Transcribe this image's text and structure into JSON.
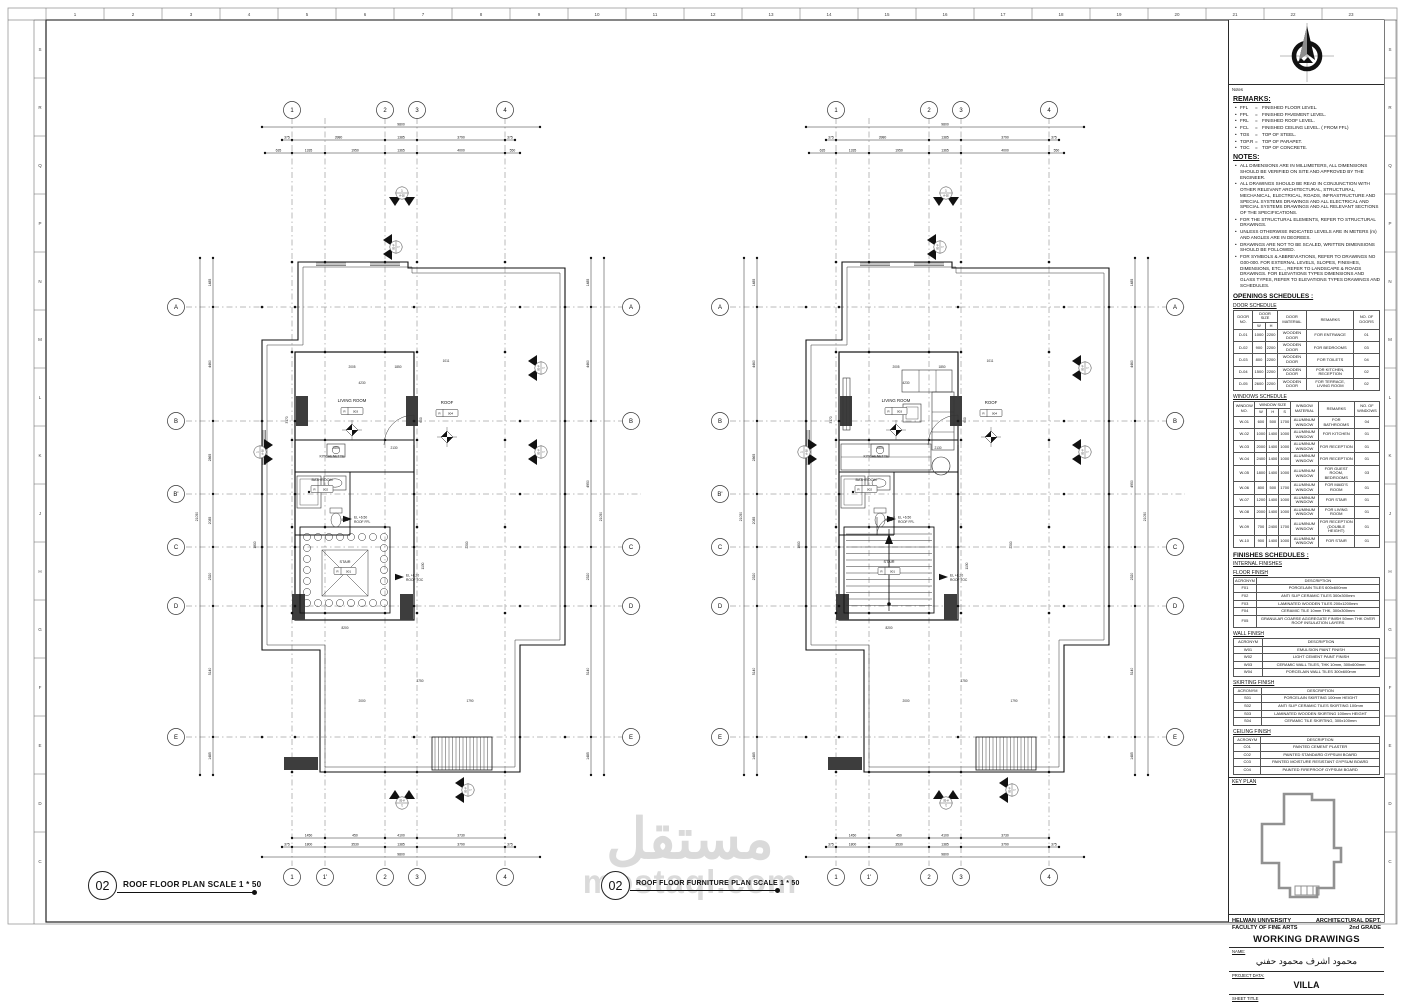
{
  "sheet": {
    "watermark_ar": "مستقل",
    "watermark_en": "mostaql.com",
    "ruler_top": [
      "1",
      "2",
      "3",
      "4",
      "5",
      "6",
      "7",
      "8",
      "9",
      "10",
      "11",
      "12",
      "13",
      "14",
      "15",
      "16",
      "17",
      "18",
      "19",
      "20",
      "21",
      "22",
      "23"
    ],
    "ruler_side": [
      "S",
      "R",
      "Q",
      "P",
      "N",
      "M",
      "L",
      "K",
      "J",
      "H",
      "G",
      "F",
      "E",
      "D",
      "C"
    ],
    "line_color": "#1a1a1a",
    "watermark_color": "#dadada"
  },
  "plan_titles": [
    {
      "number": "02",
      "label": "ROOF FLOOR PLAN SCALE 1 * 50"
    },
    {
      "number": "02",
      "label": "ROOF FLOOR FURNITURE PLAN SCALE 1 * 50"
    }
  ],
  "plans": {
    "grid_cols_top": [
      "1",
      "2",
      "3",
      "4"
    ],
    "grid_cols_bottom": [
      "1",
      "1'",
      "2",
      "3",
      "4"
    ],
    "grid_rows_left": [
      "A",
      "B",
      "B'",
      "C",
      "D",
      "E"
    ],
    "grid_rows_right": [
      "A",
      "B",
      "C",
      "D",
      "E"
    ],
    "section_tag": {
      "no": "1",
      "ref": "A-02"
    },
    "dims": {
      "top_total": "9800",
      "top_row2": [
        "375",
        "3980",
        "1385",
        "3790",
        "375"
      ],
      "top_row3": [
        "635",
        "1335",
        "1950",
        "1365",
        "4000",
        "550"
      ],
      "bottom_row1": [
        "1450",
        "450",
        "4100",
        "3730"
      ],
      "bottom_row2": [
        "375",
        "1800",
        "3530",
        "1385",
        "3790",
        "375"
      ],
      "bottom_total": "9800",
      "side_total": "21050",
      "side_segs": [
        "1485",
        "4460",
        "2865",
        "2085",
        "2320",
        "5140",
        "1485"
      ],
      "side_segs_right": [
        "1485",
        "4460",
        "4950",
        "2320",
        "5140",
        "1485"
      ],
      "inner": [
        "2005",
        "1850",
        "1011",
        "4230",
        "3170",
        "600",
        "2600",
        "2130",
        "5800",
        "1800",
        "2200",
        "1130",
        "8200",
        "3750",
        "1790",
        "2000"
      ]
    },
    "rooms": {
      "living": {
        "name": "LIVING ROOM",
        "tag_l": "R",
        "tag_n": "003"
      },
      "kitchenette": {
        "name": "KITCHENETTE"
      },
      "bathroom": {
        "name": "BATHROOM",
        "tag_l": "R",
        "tag_n": "002"
      },
      "stair": {
        "name": "STAIR",
        "tag_l": "R",
        "tag_n": "001"
      },
      "roof": {
        "name": "ROOF",
        "tag_l": "R",
        "tag_n": "004"
      }
    },
    "levels": [
      {
        "line1": "EL +6.50",
        "line2": "ROOF FFL"
      },
      {
        "line1": "EL +6.20",
        "line2": "ROOF TOC"
      }
    ]
  },
  "titleblock": {
    "issues_label": "Notes",
    "remarks_title": "REMARKS:",
    "remarks": [
      [
        "FFL",
        "FINISHED FLOOR LEVEL."
      ],
      [
        "FPL",
        "FINISHED PAVEMENT LEVEL."
      ],
      [
        "FRL",
        "FINISHED ROOF LEVEL."
      ],
      [
        "FCL",
        "FINISHED CEILING LEVEL. ( FROM FFL)"
      ],
      [
        "TOS",
        "TOP OF STEEL."
      ],
      [
        "TOP.R",
        "TOP OF PARAPET."
      ],
      [
        "TOC",
        "TOP OF CONCRETE."
      ]
    ],
    "notes_title": "NOTES:",
    "notes": [
      "ALL DIMENSIONS ARE IN MILLIMETERS, ALL DIMENSIONS SHOULD BE VERIFIED ON SITE AND APPROVED BY THE ENGINEER.",
      "ALL DRAWINGS SHOULD BE READ IN CONJUNCTION WITH OTHER RELEVANT ARCHITECTURAL, STRUCTURAL, MECHANICAL, ELECTRICAL, ROADS, INFRASTRUCTURE AND SPECIAL SYSTEMS DRAWINGS AND ALL ELECTRICAL AND SPECIAL SYSTEMS DRAWINGS AND ALL RELEVANT SECTIONS OF THE SPECIFICATIONS.",
      "FOR THE STRUCTURAL ELEMENTS, REFER TO STRUCTURAL DRAWINGS.",
      "UNLESS OTHERWISE INDICATED LEVELS ARE IN METERS (m) AND ANGLES ARE IN DEGREES.",
      "DRAWINGS ARE NOT TO BE SCALED, WRITTEN DIMENSIONS SHOULD BE FOLLOWED.",
      "FOR SYMBOLS & ABBREVIATIONS, REFER TO DRAWINGS NO G00-000. FOR EXTERNAL LEVELS, SLOPES, FINISHES, DIMENSIONS, ETC..., REFER TO LANDSCAPE & ROADS DRAWINGS. FOR ELEVATIONS TYPES DIMENSIONS AND GLASS TYPES, REFER TO ELEVATIONS TYPES DRAWINGS AND SCHEDULES."
    ],
    "openings_title": "OPENINGS SCHEDULES :",
    "door_schedule": {
      "title": "DOOR SCHEDULE",
      "head": [
        [
          {
            "t": "DOOR NO.",
            "rs": 2
          },
          {
            "t": "DOOR SIZE",
            "cs": 2
          },
          {
            "t": "DOOR MATERIAL",
            "rs": 2
          },
          {
            "t": "REMARKS",
            "rs": 2
          },
          {
            "t": "NO. OF DOORS",
            "rs": 2
          }
        ],
        [
          {
            "t": "W"
          },
          {
            "t": "H"
          }
        ]
      ],
      "rows": [
        [
          "D-01",
          "1000",
          "2200",
          "WOODEN DOOR",
          "FOR ENTRANCE",
          "01"
        ],
        [
          "D-02",
          "900",
          "2200",
          "WOODEN DOOR",
          "FOR BEDROOMS",
          "03"
        ],
        [
          "D-03",
          "800",
          "2200",
          "WOODEN DOOR",
          "FOR TOILETS",
          "04"
        ],
        [
          "D-04",
          "1500",
          "2200",
          "WOODEN DOOR",
          "FOR KITCHEN, RECEPTION",
          "02"
        ],
        [
          "D-05",
          "2600",
          "2200",
          "WOODEN DOOR",
          "FOR TERRACE, LIVING ROOM",
          "02"
        ]
      ]
    },
    "window_schedule": {
      "title": "WINDOWS SCHEDULE",
      "head": [
        [
          {
            "t": "WINDOW NO.",
            "rs": 2
          },
          {
            "t": "WINDOW SIZE",
            "cs": 3
          },
          {
            "t": "WINDOW MATERIAL",
            "rs": 2
          },
          {
            "t": "REMARKS",
            "rs": 2
          },
          {
            "t": "NO. OF WINDOWS",
            "rs": 2
          }
        ],
        [
          {
            "t": "W"
          },
          {
            "t": "H"
          },
          {
            "t": "S"
          }
        ]
      ],
      "rows": [
        [
          "W-01",
          "600",
          "500",
          "1700",
          "ALUMINUM WINDOW",
          "FOR BATHROOMS",
          "04"
        ],
        [
          "W-02",
          "1000",
          "1400",
          "1000",
          "ALUMINUM WINDOW",
          "FOR KITCHEN",
          "01"
        ],
        [
          "W-03",
          "2000",
          "1400",
          "1000",
          "ALUMINUM WINDOW",
          "FOR RECEPTION",
          "01"
        ],
        [
          "W-04",
          "2400",
          "1400",
          "1000",
          "ALUMINUM WINDOW",
          "FOR RECEPTION",
          "01"
        ],
        [
          "W-05",
          "1800",
          "1400",
          "1000",
          "ALUMINUM WINDOW",
          "FOR GUEST ROOM, BEDROOMS",
          "03"
        ],
        [
          "W-06",
          "800",
          "500",
          "1700",
          "ALUMINUM WINDOW",
          "FOR MAID'S ROOM",
          "01"
        ],
        [
          "W-07",
          "1200",
          "1400",
          "1000",
          "ALUMINUM WINDOW",
          "FOR STAIR",
          "01"
        ],
        [
          "W-08",
          "2000",
          "1400",
          "1000",
          "ALUMINUM WINDOW",
          "FOR LIVING ROOM",
          "01"
        ],
        [
          "W-09",
          "700",
          "2400",
          "1700",
          "ALUMINUM WINDOW",
          "FOR RECEPTION (DOUBLE HEIGHT)",
          "01"
        ],
        [
          "W-10",
          "900",
          "1400",
          "1000",
          "ALUMINUM WINDOW",
          "FOR STAIR",
          "01"
        ]
      ]
    },
    "finishes_title": "FINISHES SCHEDULES :",
    "internal_finishes": "INTERNAL FINISHES",
    "floor_finish": {
      "title": "FLOOR FINISH",
      "head": [
        [
          {
            "t": "ACRONYM"
          },
          {
            "t": "DESCRIPTION"
          }
        ]
      ],
      "rows": [
        [
          "F01",
          "PORCELAIN TILES 600x600mm"
        ],
        [
          "F02",
          "ANTI SLIP CERAMIC TILES 300x300mm"
        ],
        [
          "F03",
          "LAMINATED WOODEN TILES 200x1200mm"
        ],
        [
          "F04",
          "CERAMIC TILE 10mm THK, 300x300mm"
        ],
        [
          "F05",
          "GRANULAR COARSE AGGREGATE FINISH 50mm THK OVER ROOF INSULATION LAYERS"
        ]
      ]
    },
    "wall_finish": {
      "title": "WALL FINISH",
      "head": [
        [
          {
            "t": "ACRONYM"
          },
          {
            "t": "DESCRIPTION"
          }
        ]
      ],
      "rows": [
        [
          "W01",
          "EMULSION PAINT FINISH"
        ],
        [
          "W02",
          "LIGHT CEMENT PAINT FINISH"
        ],
        [
          "W03",
          "CERAMIC WALL TILES, THK 10mm, 300x600mm"
        ],
        [
          "W04",
          "PORCELAIN WALL TILES 300x600mm"
        ]
      ]
    },
    "skirting_finish": {
      "title": "SKIRTING FINISH",
      "head": [
        [
          {
            "t": "ACRONYM"
          },
          {
            "t": "DESCRIPTION"
          }
        ]
      ],
      "rows": [
        [
          "S01",
          "PORCELAIN SKIRTING 100mm HEIGHT"
        ],
        [
          "S02",
          "ANTI SLIP CERAMIC TILES SKIRTING 100mm"
        ],
        [
          "S03",
          "LAMINATED WOODEN SKIRTING 100mm HEIGHT"
        ],
        [
          "S04",
          "CERAMIC TILE SKIRTING, 300x100mm"
        ]
      ]
    },
    "ceiling_finish": {
      "title": "CEILING FINISH",
      "head": [
        [
          {
            "t": "ACRONYM"
          },
          {
            "t": "DESCRIPTION"
          }
        ]
      ],
      "rows": [
        [
          "C01",
          "PAINTED CEMENT PLASTER"
        ],
        [
          "C02",
          "PAINTED STANDARD GYPSUM BOARD"
        ],
        [
          "C03",
          "PAINTED MOISTURE RESISTANT GYPSUM BOARD"
        ],
        [
          "C04",
          "PAINTED FIREPROOF GYPSUM BOARD"
        ]
      ]
    },
    "key_plan_label": "KEY PLAN",
    "university": "HELWAN UNIVERSITY",
    "faculty": "FACULTY OF FINE ARTS",
    "dept": "ARCHITECTURAL DEPT.",
    "grade": "2nd GRADE",
    "working_drawings": "WORKING DRAWINGS",
    "name_label": "NAME:",
    "student_name": "محمود اشرف محمود حفني",
    "project_data_label": "PROJECT DATA:",
    "project": "VILLA",
    "sheet_title_label": "SHEET TITLE"
  }
}
